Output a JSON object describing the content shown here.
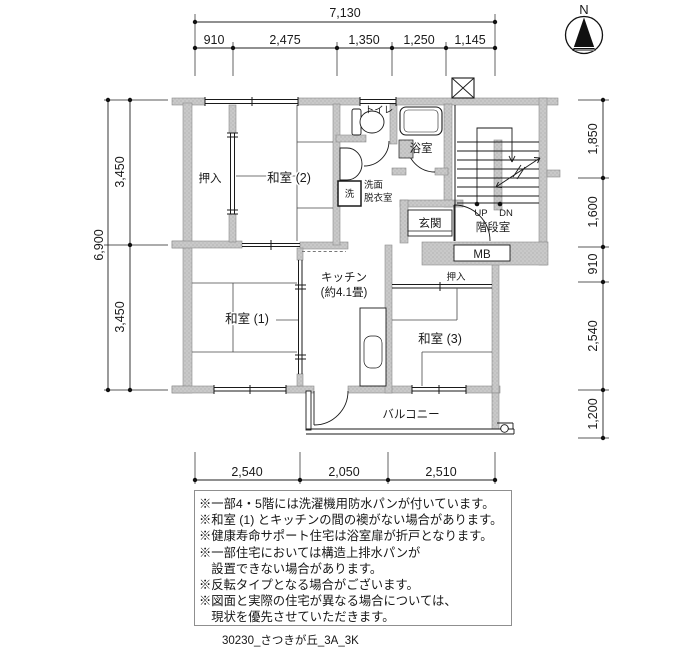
{
  "compass": {
    "north_label": "N"
  },
  "dimensions": {
    "top": {
      "total": "7,130",
      "segments": [
        "910",
        "2,475",
        "1,350",
        "1,250",
        "1,145"
      ]
    },
    "left": {
      "total": "6,900",
      "segments": [
        "3,450",
        "3,450"
      ]
    },
    "right": {
      "segments": [
        "1,850",
        "1,600",
        "910",
        "2,540",
        "1,200"
      ]
    },
    "bottom": {
      "segments": [
        "2,540",
        "2,050",
        "2,510"
      ]
    }
  },
  "rooms": {
    "closet_left": "押入",
    "japanese_room_2": "和室 (2)",
    "toilet": "トイレ",
    "bath": "浴室",
    "washroom_line1": "洗面",
    "washroom_line2": "脱衣室",
    "washer": "洗",
    "entrance": "玄関",
    "stair_up": "UP",
    "stair_down": "DN",
    "stairwell": "階段室",
    "meter_box": "MB",
    "closet_right": "押入",
    "kitchen_line1": "キッチン",
    "kitchen_line2": "(約4.1畳)",
    "japanese_room_1": "和室 (1)",
    "japanese_room_3": "和室 (3)",
    "balcony": "バルコニー"
  },
  "notes": {
    "lines": [
      "※一部4・5階には洗濯機用防水パンが付いています。",
      "※和室 (1) とキッチンの間の襖がない場合があります。",
      "※健康寿命サポート住宅は浴室扉が折戸となります。",
      "※一部住宅においては構造上排水パンが",
      "　設置できない場合があります。",
      "※反転タイプとなる場合がございます。",
      "※図面と実際の住宅が異なる場合については、",
      "　現状を優先させていただきます。"
    ]
  },
  "footer": {
    "plan_id": "30230_さつきが丘_3A_3K"
  },
  "colors": {
    "wall": "#c9c9c9",
    "line": "#1a1a1a"
  }
}
